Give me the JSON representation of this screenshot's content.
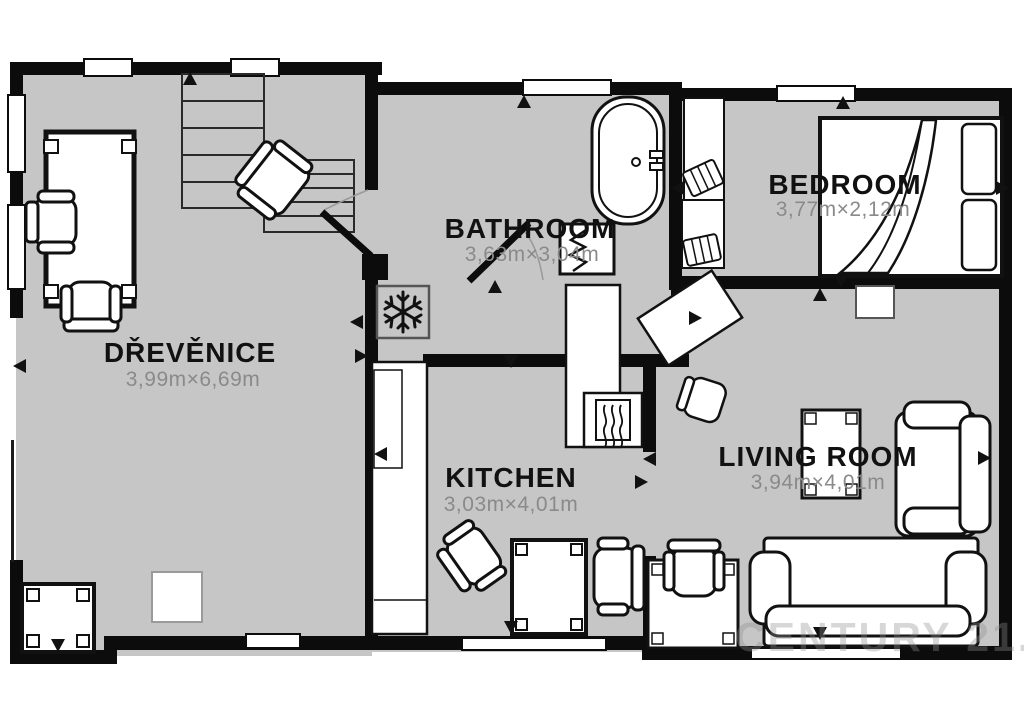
{
  "plan": {
    "title": "Floor plan",
    "rooms": [
      {
        "id": "drevenice",
        "name": "DŘEVĚNICE",
        "dims": "3,99m×6,69m"
      },
      {
        "id": "bathroom",
        "name": "BATHROOM",
        "dims": "3,63m×3,04m"
      },
      {
        "id": "bedroom",
        "name": "BEDROOM",
        "dims": "3,77m×2,12m"
      },
      {
        "id": "kitchen",
        "name": "KITCHEN",
        "dims": "3,03m×4,01m"
      },
      {
        "id": "living_room",
        "name": "LIVING ROOM",
        "dims": "3,94m×4,01m"
      }
    ],
    "watermark": "CENTURY 21.",
    "icons": {
      "freezer": "snowflake-icon",
      "heater": "heating-waves-icon",
      "markers": "direction-arrow-icon"
    },
    "colors": {
      "floor": "#c6c6c6",
      "wall": "#0c0c0c",
      "furniture_fill": "#ffffff",
      "furniture_stroke": "#111111",
      "dims_text": "#8a8a8a",
      "room_text": "#111111",
      "watermark": "#8f8f8f"
    }
  }
}
